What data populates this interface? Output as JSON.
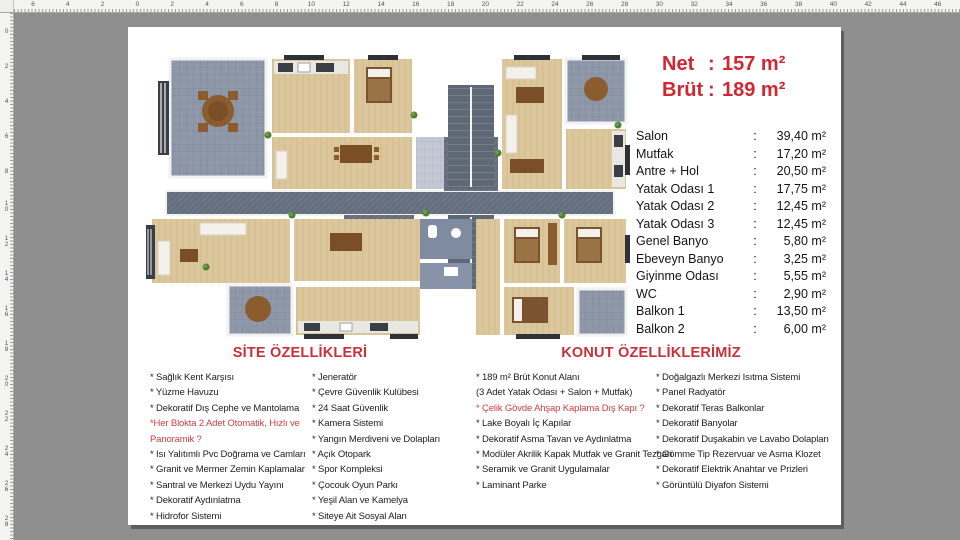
{
  "rulers": {
    "top": [
      "6",
      "4",
      "2",
      "0",
      "2",
      "4",
      "6",
      "8",
      "10",
      "12",
      "14",
      "16",
      "18",
      "20",
      "22",
      "24",
      "26",
      "28",
      "30",
      "32",
      "34",
      "36",
      "38",
      "40",
      "42",
      "44",
      "46"
    ],
    "left": [
      "0",
      "2",
      "4",
      "6",
      "8",
      "10",
      "12",
      "14",
      "16",
      "18",
      "20",
      "22",
      "24",
      "26",
      "28"
    ]
  },
  "info": {
    "net_label": "Net",
    "net_value": "157 m²",
    "brut_label": "Brüt",
    "brut_value": "189 m²",
    "rooms": [
      {
        "label": "Salon",
        "value": "39,40 m²"
      },
      {
        "label": "Mutfak",
        "value": "17,20 m²"
      },
      {
        "label": "Antre + Hol",
        "value": "20,50 m²"
      },
      {
        "label": "Yatak Odası 1",
        "value": "17,75 m²"
      },
      {
        "label": "Yatak Odası 2",
        "value": "12,45 m²"
      },
      {
        "label": "Yatak Odası 3",
        "value": "12,45 m²"
      },
      {
        "label": "Genel Banyo",
        "value": "5,80 m²"
      },
      {
        "label": "Ebeveyn Banyo",
        "value": "3,25 m²"
      },
      {
        "label": "Giyinme Odası",
        "value": "5,55 m²"
      },
      {
        "label": "WC",
        "value": "2,90 m²"
      },
      {
        "label": "Balkon 1",
        "value": "13,50 m²"
      },
      {
        "label": "Balkon 2",
        "value": "6,00 m²"
      }
    ]
  },
  "features": {
    "site_title": "SİTE ÖZELLİKLERİ",
    "site_col1": [
      {
        "t": "* Sağlık Kent Karşısı"
      },
      {
        "t": "* Yüzme Havuzu"
      },
      {
        "t": "* Dekoratif Dış Cephe ve Mantolama"
      },
      {
        "t": "*Her Blokta 2 Adet Otomatik, Hızlı ve Panoramik ?",
        "red": true,
        "wrap": true
      },
      {
        "t": "* Isı Yalıtımlı Pvc Doğrama ve Camları"
      },
      {
        "t": "* Granit ve Mermer Zemin Kaplamalar"
      },
      {
        "t": "* Santral ve Merkezi Uydu Yayını"
      },
      {
        "t": "* Dekoratif Aydınlatma"
      },
      {
        "t": "* Hidrofor Sistemi"
      }
    ],
    "site_col2": [
      {
        "t": "* Jeneratör"
      },
      {
        "t": "* Çevre Güvenlik Kulübesi"
      },
      {
        "t": "* 24 Saat Güvenlik"
      },
      {
        "t": "* Kamera Sistemi"
      },
      {
        "t": "* Yangın Merdiveni ve Dolapları"
      },
      {
        "t": "* Açık Otopark"
      },
      {
        "t": "* Spor Kompleksi"
      },
      {
        "t": "* Çocouk Oyun Parkı"
      },
      {
        "t": "* Yeşil Alan ve Kamelya"
      },
      {
        "t": "* Siteye Ait Sosyal Alan"
      }
    ],
    "konut_title": "KONUT ÖZELLİKLERİMİZ",
    "konut_col1": [
      {
        "t": "* 189 m² Brüt Konut Alanı"
      },
      {
        "t": "(3 Adet Yatak Odası + Salon + Mutfak)"
      },
      {
        "t": "* Çelik Gövde Ahşap Kaplama Dış Kapı ?",
        "red": true
      },
      {
        "t": "* Lake Boyalı İç Kapılar"
      },
      {
        "t": "* Dekoratif Asma Tavan ve Aydınlatma"
      },
      {
        "t": "* Modüler Akrilik Kapak Mutfak ve Granit Tezgah"
      },
      {
        "t": "* Seramik ve Granit Uygulamalar"
      },
      {
        "t": "* Laminant Parke"
      }
    ],
    "konut_col2": [
      {
        "t": "* Doğalgazlı Merkezi Isıtma Sistemi"
      },
      {
        "t": "* Panel Radyatör"
      },
      {
        "t": "* Dekoratif Teras Balkonlar"
      },
      {
        "t": "* Dekoratif Banyolar"
      },
      {
        "t": "* Dekoratif Duşakabin ve Lavabo Dolapları"
      },
      {
        "t": "* Gömme Tip Rezervuar ve Asma Klozet"
      },
      {
        "t": "* Dekoratif Elektrik Anahtar ve Prizleri"
      },
      {
        "t": "* Görüntülü Diyafon Sistemi"
      }
    ]
  },
  "colors": {
    "accent_red": "#d02733",
    "workspace_gray": "#8f8f8f",
    "wood_floor": "#dcc79c",
    "balcony_tile": "#8e98a9",
    "corridor": "#6b7482"
  },
  "floorplan": {
    "alt": "apartment-floor-plan"
  }
}
